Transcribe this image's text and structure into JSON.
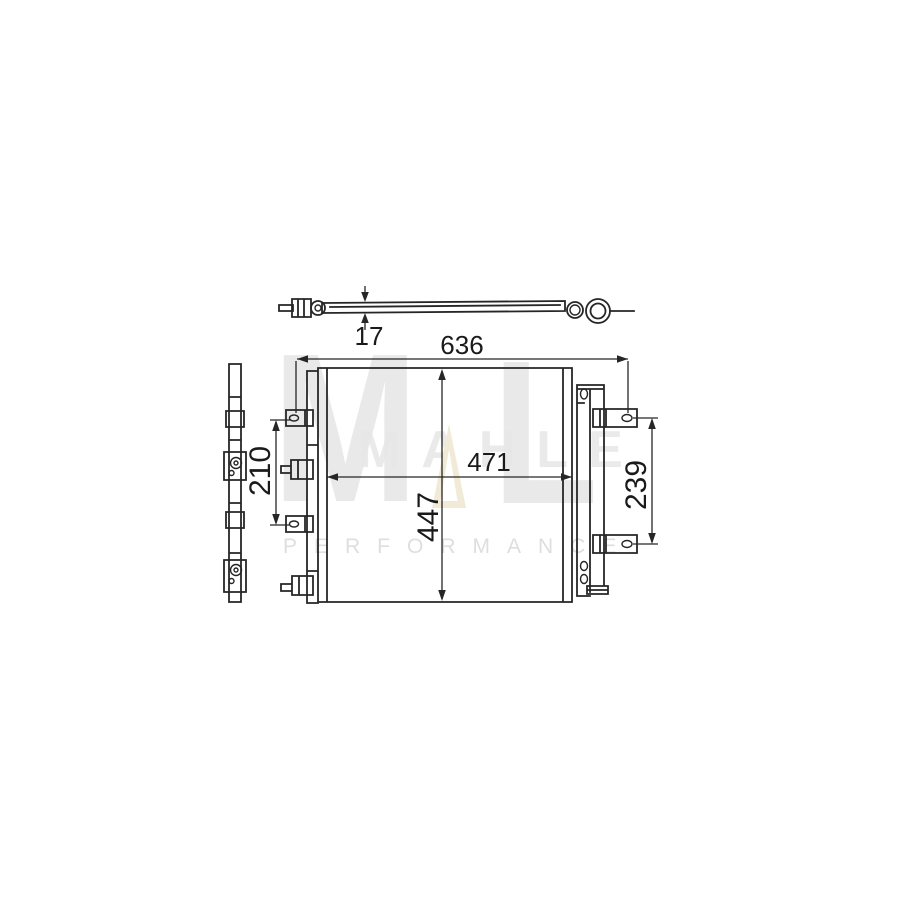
{
  "canvas": {
    "background_hex": "#ffffff",
    "line_hex": "#262626"
  },
  "watermark": {
    "letter_m": "M",
    "letter_l": "L",
    "brand_text": "MAHLE",
    "subtitle_text": "PERFORMANCE",
    "gray_hex": "#e9e9e9",
    "gold_hex": "#f1ead7"
  },
  "dimensions": {
    "thickness": "17",
    "overall_width": "636",
    "core_width": "471",
    "height": "447",
    "left_bracket_spacing": "210",
    "right_bracket_spacing": "239"
  }
}
